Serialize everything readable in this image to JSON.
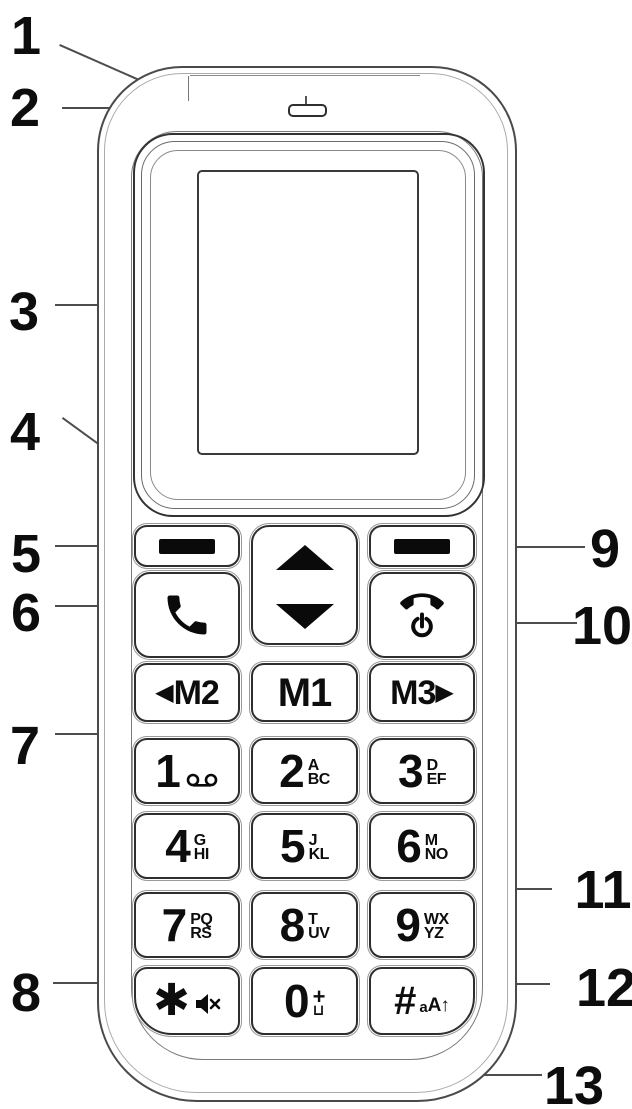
{
  "callouts": {
    "c1": "1",
    "c2": "2",
    "c3": "3",
    "c4": "4",
    "c5": "5",
    "c6": "6",
    "c7": "7",
    "c8": "8",
    "c9": "9",
    "c10": "10",
    "c11": "11",
    "c12": "12",
    "c13": "13"
  },
  "keys": {
    "m2": {
      "arrow": "◀",
      "label": "M2"
    },
    "m1": {
      "label": "M1"
    },
    "m3": {
      "label": "M3",
      "arrow": "▶"
    },
    "k1": {
      "digit": "1"
    },
    "k2": {
      "digit": "2",
      "letters_top": "A",
      "letters_bottom": "BC"
    },
    "k3": {
      "digit": "3",
      "letters_top": "D",
      "letters_bottom": "EF"
    },
    "k4": {
      "digit": "4",
      "letters_top": "G",
      "letters_bottom": "HI"
    },
    "k5": {
      "digit": "5",
      "letters_top": "J",
      "letters_bottom": "KL"
    },
    "k6": {
      "digit": "6",
      "letters_top": "M",
      "letters_bottom": "NO"
    },
    "k7": {
      "digit": "7",
      "letters_top": "PQ",
      "letters_bottom": "RS"
    },
    "k8": {
      "digit": "8",
      "letters_top": "T",
      "letters_bottom": "UV"
    },
    "k9": {
      "digit": "9",
      "letters_top": "WX",
      "letters_bottom": "YZ"
    },
    "kstar": {
      "symbol": "✱"
    },
    "k0": {
      "digit": "0",
      "plus": "+",
      "space": "⊔"
    },
    "khash": {
      "symbol": "#",
      "small_a": "a",
      "cap_a": "A",
      "arrow": "↑"
    }
  },
  "colors": {
    "ink": "#0d0d0d",
    "outline": "#2e2e2e",
    "leader": "#4d4d4d",
    "background": "#ffffff"
  }
}
